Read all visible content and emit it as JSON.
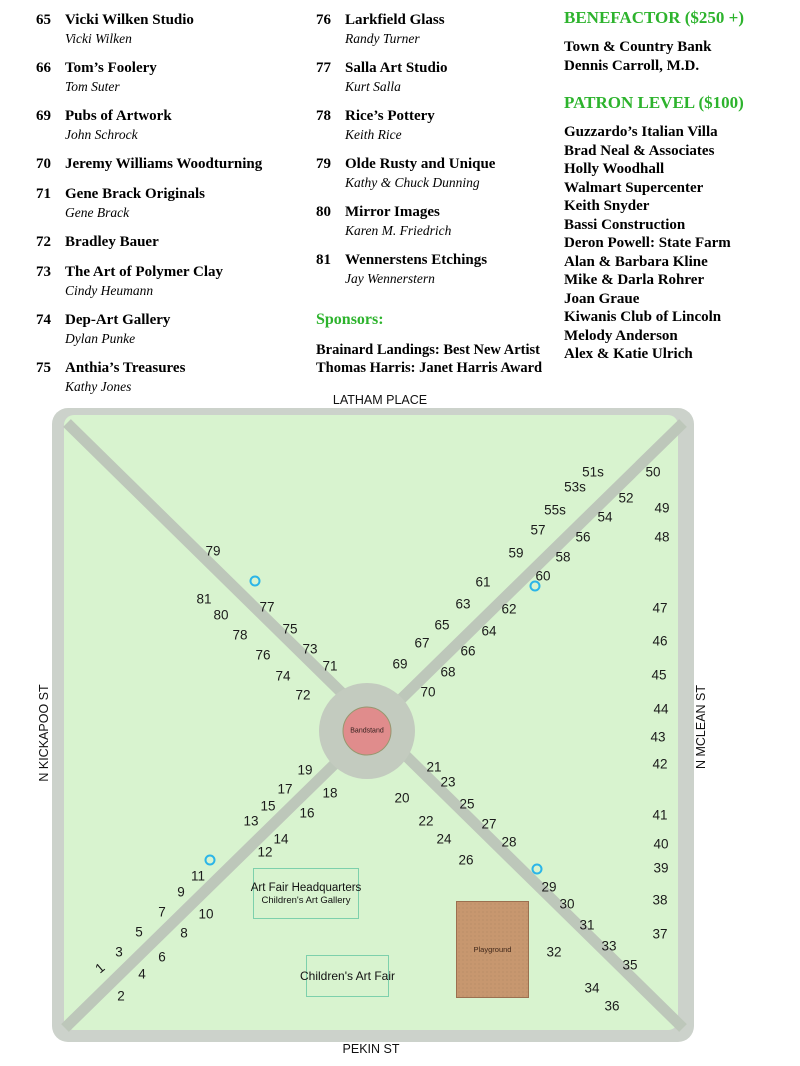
{
  "exhibitors": {
    "columns": [
      [
        {
          "num": "65",
          "name": "Vicki Wilken Studio",
          "artist": "Vicki Wilken"
        },
        {
          "num": "66",
          "name": "Tom’s Foolery",
          "artist": "Tom Suter"
        },
        {
          "num": "69",
          "name": "Pubs of Artwork",
          "artist": "John Schrock"
        },
        {
          "num": "70",
          "name": "Jeremy Williams Woodturning",
          "artist": ""
        },
        {
          "num": "71",
          "name": "Gene Brack Originals",
          "artist": "Gene Brack"
        },
        {
          "num": "72",
          "name": "Bradley Bauer",
          "artist": ""
        },
        {
          "num": "73",
          "name": "The Art of Polymer Clay",
          "artist": "Cindy Heumann"
        },
        {
          "num": "74",
          "name": "Dep-Art Gallery",
          "artist": "Dylan Punke"
        },
        {
          "num": "75",
          "name": "Anthia’s Treasures",
          "artist": "Kathy Jones"
        }
      ],
      [
        {
          "num": "76",
          "name": "Larkfield Glass",
          "artist": "Randy Turner"
        },
        {
          "num": "77",
          "name": "Salla Art Studio",
          "artist": "Kurt Salla"
        },
        {
          "num": "78",
          "name": "Rice’s Pottery",
          "artist": "Keith Rice"
        },
        {
          "num": "79",
          "name": "Olde Rusty and Unique",
          "artist": "Kathy & Chuck Dunning"
        },
        {
          "num": "80",
          "name": "Mirror Images",
          "artist": "Karen M. Friedrich"
        },
        {
          "num": "81",
          "name": "Wennerstens Etchings",
          "artist": "Jay Wennerstern"
        }
      ]
    ]
  },
  "sponsors": {
    "heading": "Sponsors:",
    "lines": [
      "Brainard Landings: Best New Artist",
      "Thomas Harris: Janet Harris Award"
    ]
  },
  "benefactor": {
    "heading": "BENEFACTOR ($250 +)",
    "items": [
      "Town & Country Bank",
      "Dennis Carroll, M.D."
    ]
  },
  "patron": {
    "heading": "PATRON LEVEL ($100)",
    "items": [
      "Guzzardo’s Italian Villa",
      "Brad Neal & Associates",
      "Holly Woodhall",
      "Walmart Supercenter",
      "Keith Snyder",
      "Bassi Construction",
      "Deron Powell: State Farm",
      "Alan & Barbara Kline",
      "Mike & Darla Rohrer",
      "Joan Graue",
      "Kiwanis Club of Lincoln",
      "Melody Anderson",
      "Alex & Katie Ulrich"
    ]
  },
  "map": {
    "streets": {
      "top": "LATHAM PLACE",
      "bottom": "PEKIN ST",
      "left": "N KICKAPOO ST",
      "right": "N MCLEAN ST"
    },
    "bandstand_label": "Bandstand",
    "playground_label": "Playground",
    "hq": {
      "line1": "Art Fair Headquarters",
      "line2": "Children's Art Gallery"
    },
    "fair": {
      "label": "Children's Art Fair"
    },
    "colors": {
      "field_green": "#d8f3cf",
      "street_gray": "#ccd2cb",
      "path_gray": "#bdc7ba",
      "plaza_gray": "#c3cbbf",
      "bandstand_pink": "#e08c8c",
      "playground_tan": "#c7976f",
      "marker_cyan": "#2bb5e8",
      "box_teal": "#7dd0ac",
      "heading_green": "#2db32d"
    },
    "booths": [
      {
        "n": "79",
        "x": 213,
        "y": 551
      },
      {
        "n": "81",
        "x": 204,
        "y": 599
      },
      {
        "n": "77",
        "x": 267,
        "y": 607
      },
      {
        "n": "80",
        "x": 221,
        "y": 615
      },
      {
        "n": "75",
        "x": 290,
        "y": 629
      },
      {
        "n": "78",
        "x": 240,
        "y": 635
      },
      {
        "n": "73",
        "x": 310,
        "y": 649
      },
      {
        "n": "76",
        "x": 263,
        "y": 655
      },
      {
        "n": "71",
        "x": 330,
        "y": 666
      },
      {
        "n": "74",
        "x": 283,
        "y": 676
      },
      {
        "n": "72",
        "x": 303,
        "y": 695
      },
      {
        "n": "51s",
        "x": 593,
        "y": 472
      },
      {
        "n": "50",
        "x": 653,
        "y": 472
      },
      {
        "n": "53s",
        "x": 575,
        "y": 487
      },
      {
        "n": "52",
        "x": 626,
        "y": 498
      },
      {
        "n": "55s",
        "x": 555,
        "y": 510
      },
      {
        "n": "54",
        "x": 605,
        "y": 517
      },
      {
        "n": "49",
        "x": 662,
        "y": 508
      },
      {
        "n": "57",
        "x": 538,
        "y": 530
      },
      {
        "n": "56",
        "x": 583,
        "y": 537
      },
      {
        "n": "48",
        "x": 662,
        "y": 537
      },
      {
        "n": "59",
        "x": 516,
        "y": 553
      },
      {
        "n": "58",
        "x": 563,
        "y": 557
      },
      {
        "n": "60",
        "x": 543,
        "y": 576
      },
      {
        "n": "61",
        "x": 483,
        "y": 582
      },
      {
        "n": "63",
        "x": 463,
        "y": 604
      },
      {
        "n": "62",
        "x": 509,
        "y": 609
      },
      {
        "n": "47",
        "x": 660,
        "y": 608
      },
      {
        "n": "65",
        "x": 442,
        "y": 625
      },
      {
        "n": "64",
        "x": 489,
        "y": 631
      },
      {
        "n": "46",
        "x": 660,
        "y": 641
      },
      {
        "n": "67",
        "x": 422,
        "y": 643
      },
      {
        "n": "66",
        "x": 468,
        "y": 651
      },
      {
        "n": "69",
        "x": 400,
        "y": 664
      },
      {
        "n": "68",
        "x": 448,
        "y": 672
      },
      {
        "n": "45",
        "x": 659,
        "y": 675
      },
      {
        "n": "70",
        "x": 428,
        "y": 692
      },
      {
        "n": "44",
        "x": 661,
        "y": 709
      },
      {
        "n": "43",
        "x": 658,
        "y": 737
      },
      {
        "n": "42",
        "x": 660,
        "y": 764
      },
      {
        "n": "21",
        "x": 434,
        "y": 767
      },
      {
        "n": "23",
        "x": 448,
        "y": 782
      },
      {
        "n": "20",
        "x": 402,
        "y": 798
      },
      {
        "n": "25",
        "x": 467,
        "y": 804
      },
      {
        "n": "41",
        "x": 660,
        "y": 815
      },
      {
        "n": "22",
        "x": 426,
        "y": 821
      },
      {
        "n": "27",
        "x": 489,
        "y": 824
      },
      {
        "n": "24",
        "x": 444,
        "y": 839
      },
      {
        "n": "28",
        "x": 509,
        "y": 842
      },
      {
        "n": "40",
        "x": 661,
        "y": 844
      },
      {
        "n": "26",
        "x": 466,
        "y": 860
      },
      {
        "n": "39",
        "x": 661,
        "y": 868
      },
      {
        "n": "29",
        "x": 549,
        "y": 887
      },
      {
        "n": "30",
        "x": 567,
        "y": 904
      },
      {
        "n": "38",
        "x": 660,
        "y": 900
      },
      {
        "n": "31",
        "x": 587,
        "y": 925
      },
      {
        "n": "37",
        "x": 660,
        "y": 934
      },
      {
        "n": "33",
        "x": 609,
        "y": 946
      },
      {
        "n": "32",
        "x": 554,
        "y": 952
      },
      {
        "n": "35",
        "x": 630,
        "y": 965
      },
      {
        "n": "34",
        "x": 592,
        "y": 988
      },
      {
        "n": "36",
        "x": 612,
        "y": 1006
      },
      {
        "n": "19",
        "x": 305,
        "y": 770
      },
      {
        "n": "17",
        "x": 285,
        "y": 789
      },
      {
        "n": "18",
        "x": 330,
        "y": 793
      },
      {
        "n": "15",
        "x": 268,
        "y": 806
      },
      {
        "n": "16",
        "x": 307,
        "y": 813
      },
      {
        "n": "13",
        "x": 251,
        "y": 821
      },
      {
        "n": "14",
        "x": 281,
        "y": 839
      },
      {
        "n": "12",
        "x": 265,
        "y": 852
      },
      {
        "n": "11",
        "x": 198,
        "y": 876
      },
      {
        "n": "9",
        "x": 181,
        "y": 892
      },
      {
        "n": "7",
        "x": 162,
        "y": 912
      },
      {
        "n": "10",
        "x": 206,
        "y": 914
      },
      {
        "n": "5",
        "x": 139,
        "y": 932
      },
      {
        "n": "8",
        "x": 184,
        "y": 933
      },
      {
        "n": "3",
        "x": 119,
        "y": 952
      },
      {
        "n": "6",
        "x": 162,
        "y": 957
      },
      {
        "n": "1",
        "x": 100,
        "y": 968,
        "rot": -40
      },
      {
        "n": "4",
        "x": 142,
        "y": 974
      },
      {
        "n": "2",
        "x": 121,
        "y": 996
      }
    ],
    "markers": [
      {
        "x": 255,
        "y": 581
      },
      {
        "x": 535,
        "y": 586
      },
      {
        "x": 210,
        "y": 860
      },
      {
        "x": 537,
        "y": 869
      }
    ]
  }
}
